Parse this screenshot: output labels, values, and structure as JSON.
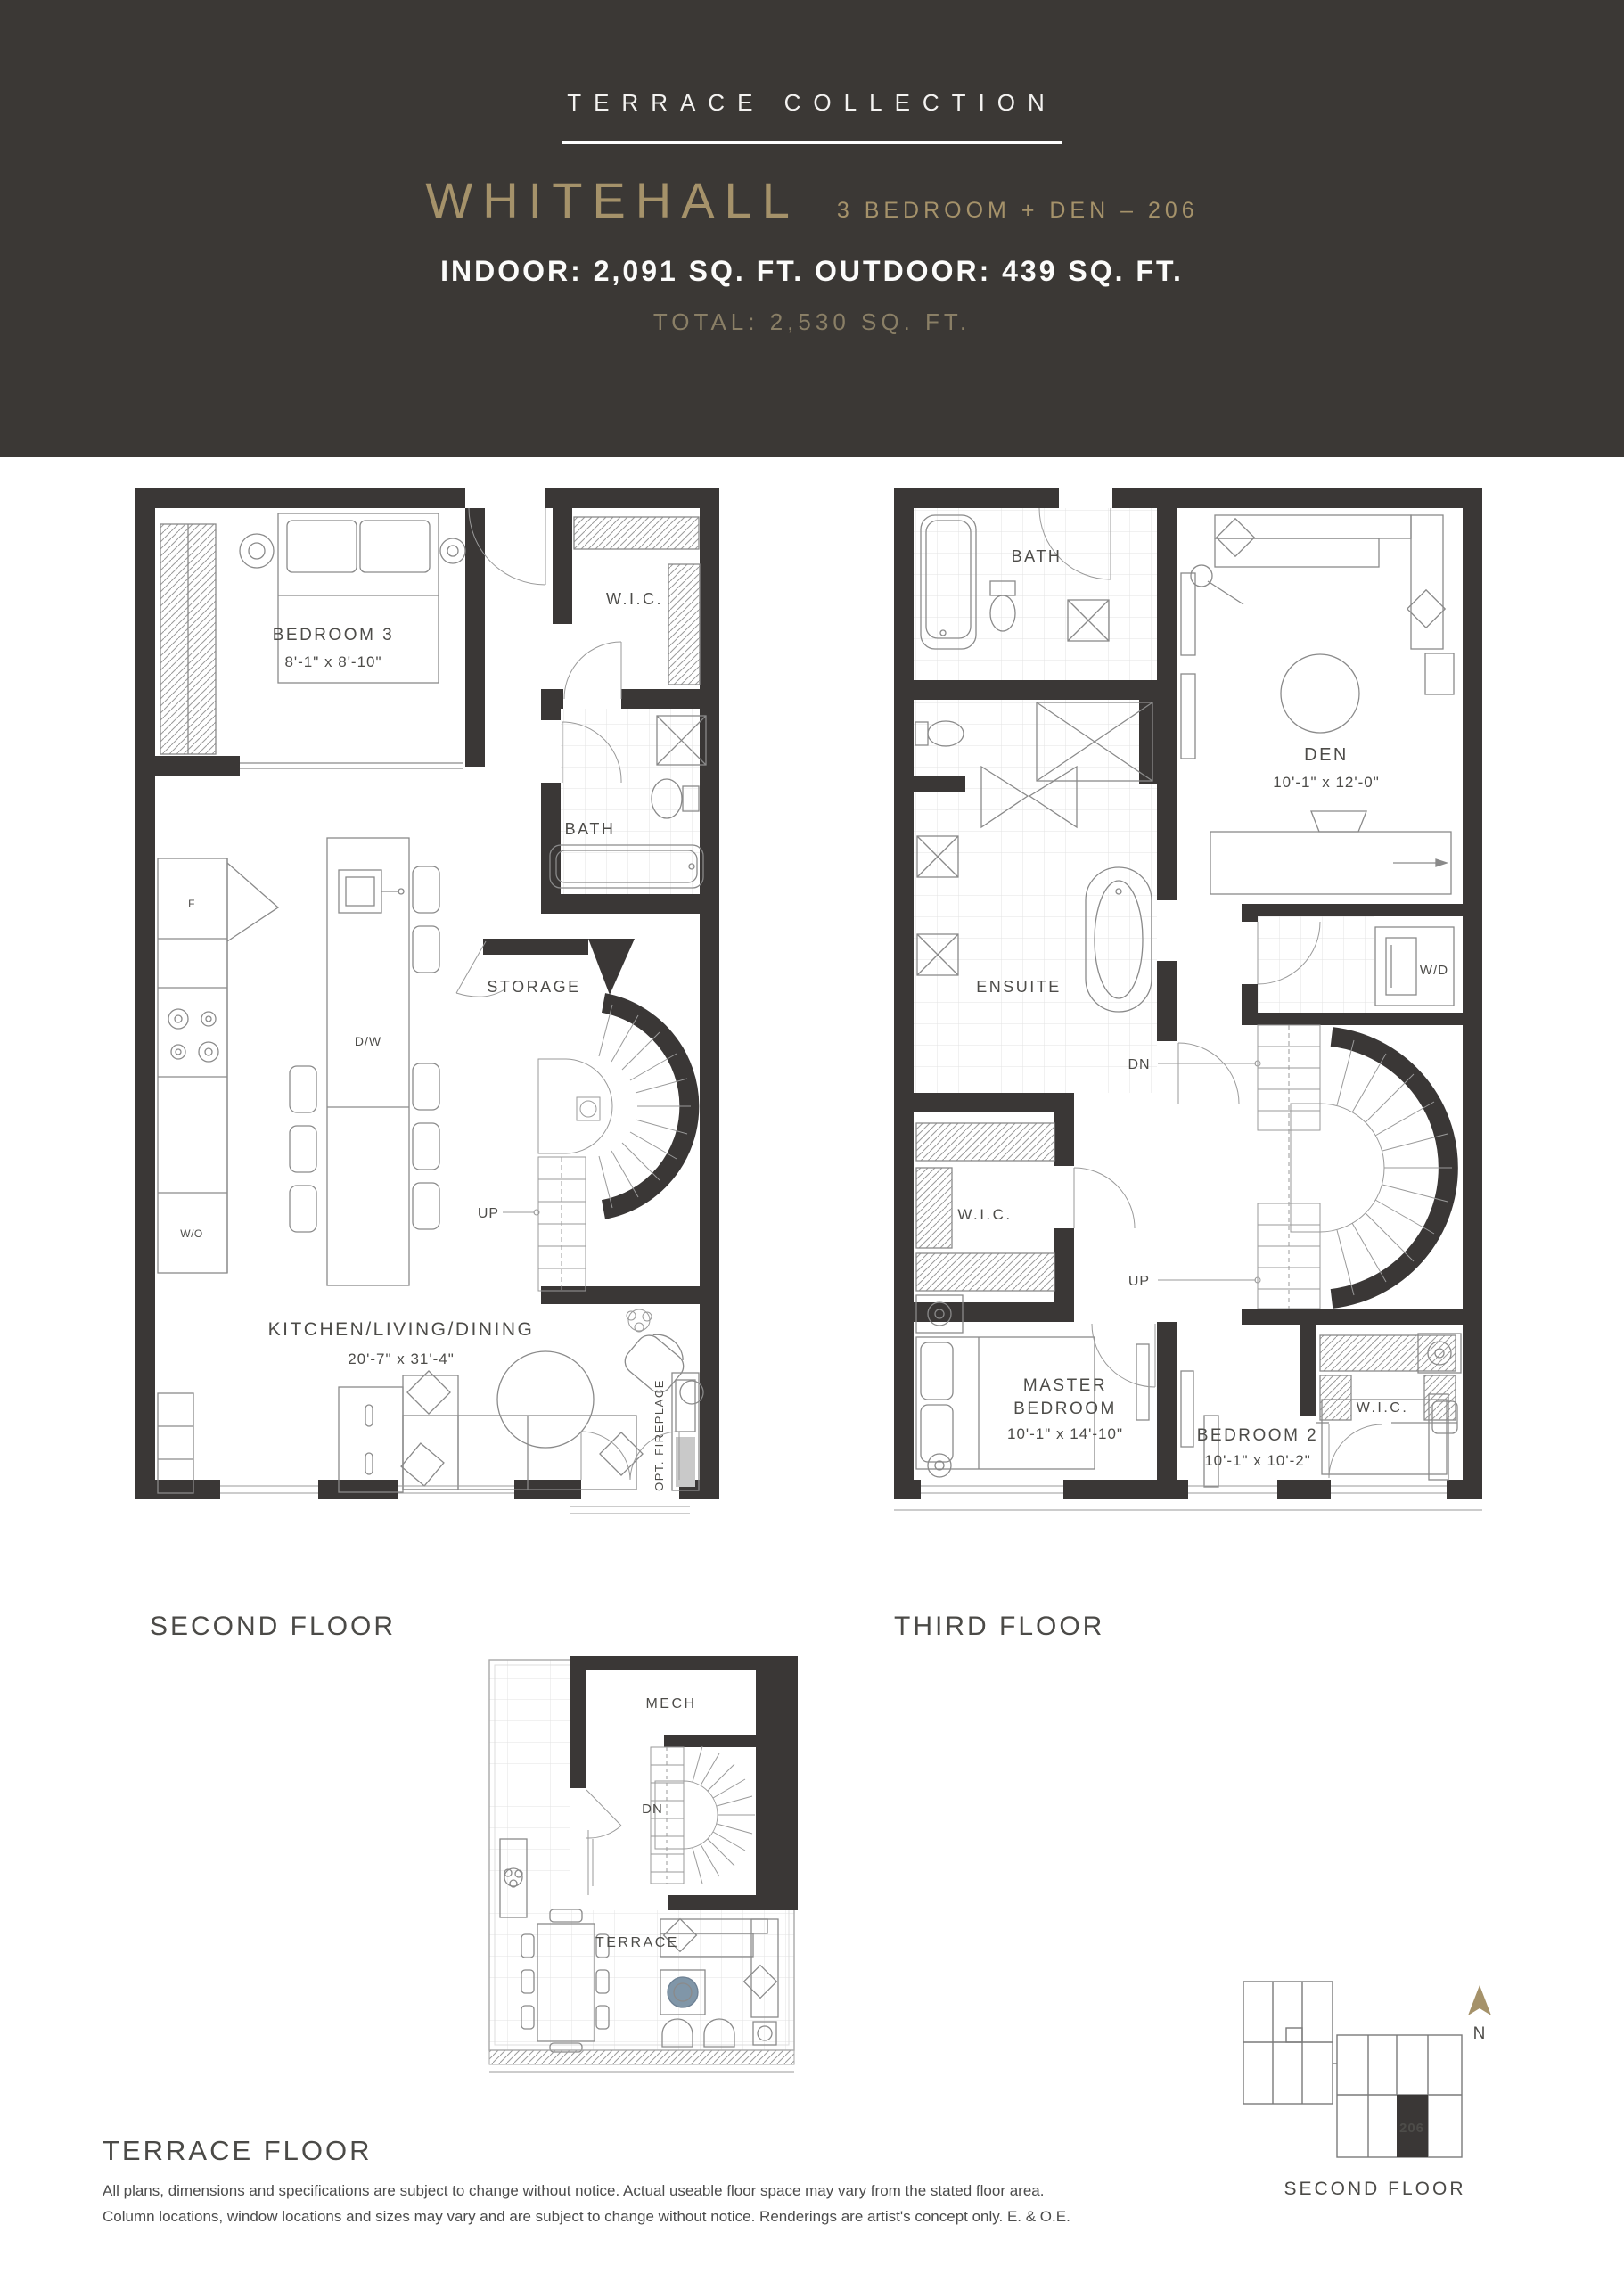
{
  "header": {
    "collection": "TERRACE COLLECTION",
    "plan_name": "WHITEHALL",
    "plan_subtitle": "3 BEDROOM + DEN – 206",
    "area_line": "INDOOR: 2,091 SQ. FT. OUTDOOR: 439 SQ. FT.",
    "total_line": "TOTAL: 2,530 SQ. FT."
  },
  "floors": {
    "second": {
      "caption": "SECOND FLOOR",
      "rooms": {
        "bedroom3": {
          "name": "BEDROOM 3",
          "dims": "8'-1\" x 8'-10\""
        },
        "wic": "W.I.C.",
        "bath": "BATH",
        "storage": "STORAGE",
        "up": "UP",
        "dw": "D/W",
        "fridge": "F",
        "wall_oven": "W/O",
        "kld": {
          "name": "KITCHEN/LIVING/DINING",
          "dims": "20'-7\" x 31'-4\""
        },
        "opt_fireplace": "OPT. FIREPLACE"
      }
    },
    "third": {
      "caption": "THIRD FLOOR",
      "rooms": {
        "bath": "BATH",
        "den": {
          "name": "DEN",
          "dims": "10'-1\" x 12'-0\""
        },
        "ensuite": "ENSUITE",
        "wd": "W/D",
        "wic_left": "W.I.C.",
        "dn": "DN",
        "up": "UP",
        "wic_right": "W.I.C.",
        "master": {
          "name_line1": "MASTER",
          "name_line2": "BEDROOM",
          "dims": "10'-1\" x 14'-10\""
        },
        "bedroom2": {
          "name": "BEDROOM 2",
          "dims": "10'-1\" x 10'-2\""
        }
      }
    },
    "terrace": {
      "caption": "TERRACE FLOOR",
      "rooms": {
        "mech": "MECH",
        "dn": "DN",
        "terrace": "TERRACE"
      }
    }
  },
  "keyplan": {
    "unit": "206",
    "north_label": "N",
    "caption": "SECOND FLOOR"
  },
  "disclaimer": {
    "line1": "All plans, dimensions and specifications are subject to change without notice. Actual useable floor space may vary from the stated floor area.",
    "line2": "Column locations, window locations and sizes may vary and are subject to change without notice. Renderings are artist's concept only. E. & O.E."
  },
  "colors": {
    "header_bg": "#3B3835",
    "gold": "#A5926A",
    "muted_gold": "#8A7F66",
    "wall": "#3A3736",
    "furniture_line": "#8A8A8A",
    "label": "#4D4C49",
    "fire_bowl": "#8096A8"
  }
}
